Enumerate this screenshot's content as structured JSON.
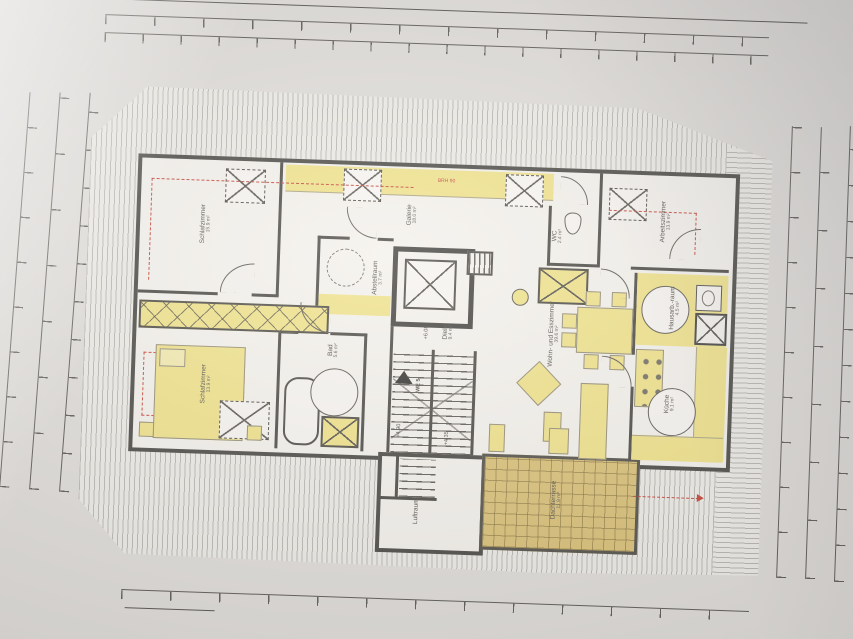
{
  "drawing": {
    "kind": "attic floor plan (photographed blueprint)",
    "unit_label": "WE 5"
  },
  "rooms": [
    {
      "id": "schlafzimmer-1",
      "label": "Schlafzimmer",
      "area": "15.9 m²"
    },
    {
      "id": "galerie",
      "label": "Galerie",
      "area": "18.0 m²"
    },
    {
      "id": "arbeitszimmer",
      "label": "Arbeitszimmer",
      "area": "13.9 m²"
    },
    {
      "id": "wc",
      "label": "WC",
      "area": "2.4 m²"
    },
    {
      "id": "abstellraum",
      "label": "Abstellraum",
      "area": "3.7 m²"
    },
    {
      "id": "schlafzimmer-2",
      "label": "Schlafzimmer",
      "area": "13.9 m²"
    },
    {
      "id": "bad",
      "label": "Bad",
      "area": "5.6 m²"
    },
    {
      "id": "diele",
      "label": "Diele",
      "area": "9.4 m²"
    },
    {
      "id": "wohn-esszimmer",
      "label": "Wohn- und Esszimmer",
      "area": "39.6 m²"
    },
    {
      "id": "hausarbeitsraum",
      "label": "Hausarb.-raum",
      "area": "4.5 m²"
    },
    {
      "id": "kueche",
      "label": "Küche",
      "area": "9.1 m²"
    },
    {
      "id": "dachterrasse",
      "label": "Dachterrasse",
      "area": "11.9 m²"
    },
    {
      "id": "luftraum",
      "label": "Luftraum",
      "area": ""
    }
  ],
  "annotations": {
    "level_gallery": "+6.08",
    "level_mid": "+4.90",
    "level_lower": "+4.35",
    "unit": "WE 5",
    "parapet_top": "BRH 90",
    "parapet_bedroom": "BRH 90"
  },
  "colors": {
    "wall": "#42403a",
    "highlight_yellow": "#efe083",
    "terrace_tan": "#d8bd6f",
    "annotation_red": "#c23b2e",
    "paper": "#f3f0ea"
  }
}
